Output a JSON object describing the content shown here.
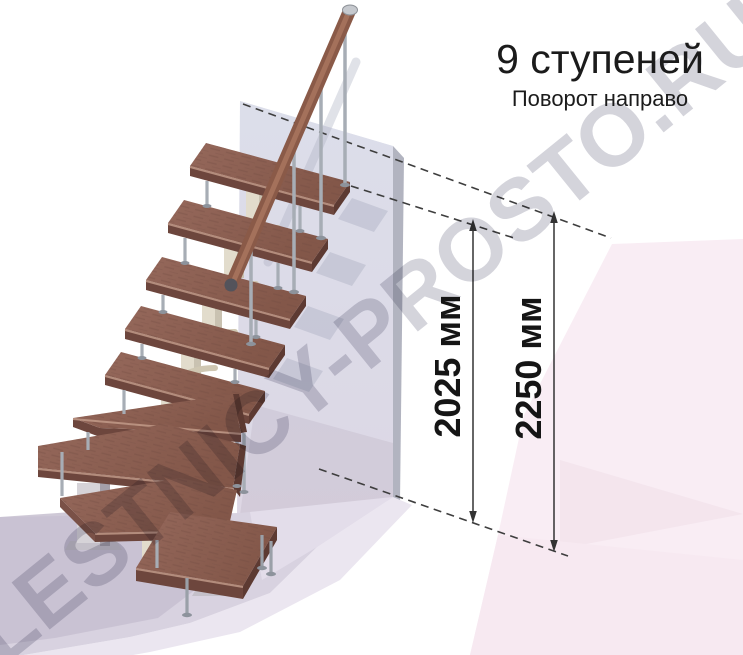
{
  "header": {
    "title": "9 ступеней",
    "subtitle": "Поворот направо"
  },
  "dimensions": {
    "stair_height": "2025 мм",
    "total_height": "2250 мм"
  },
  "watermark": {
    "text": "LESTNICY-PROSTO.RU"
  },
  "scene": {
    "steps_visible": 9,
    "straight_treads": 5,
    "winder_treads": 3,
    "bottom_tread": 1
  },
  "colors": {
    "text": "#1b1b1b",
    "dimension_line": "#3a3a3a",
    "tread_wood": "#8d6156",
    "tread_edge": "#6d463d",
    "handrail_wood": "#8a5a48",
    "metal_pole": "#a7adb5",
    "bracket_beige": "#d8d0bd",
    "wall_face": "#dcdeea",
    "wall_edge": "#b2b4c0",
    "floor_lavender": "#d8d2e0",
    "background_pink": "#f9edf4",
    "watermark_gray": "#c3c3cd"
  }
}
